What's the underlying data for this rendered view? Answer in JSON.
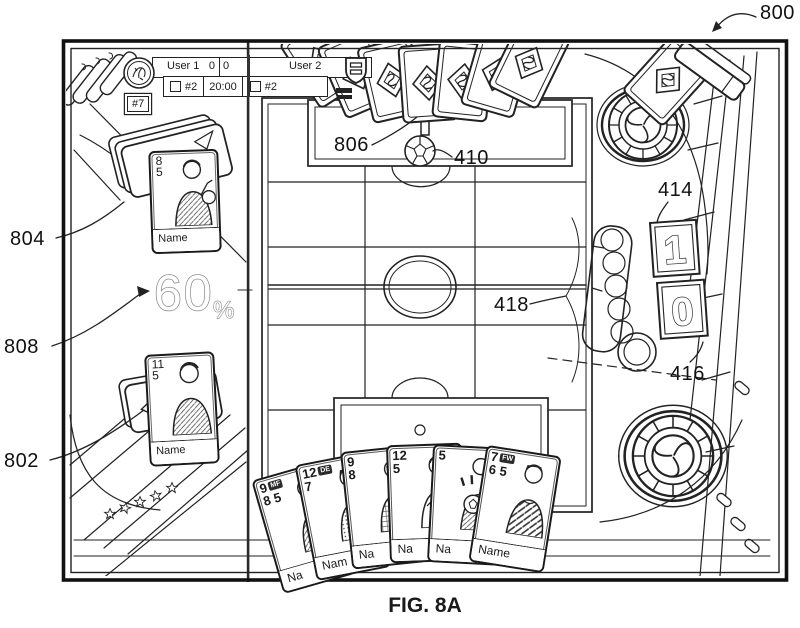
{
  "figure": {
    "label": "800",
    "caption": "FIG. 8A"
  },
  "refs": {
    "r804": "804",
    "r808": "808",
    "r802": "802",
    "r806": "806",
    "r410": "410",
    "r414": "414",
    "r416": "416",
    "r418": "418"
  },
  "scoreboard": {
    "user1": "User 1",
    "score_left": "0",
    "score_right": "0",
    "user2": "User 2",
    "left_jersey": "#2",
    "timer": "20:00",
    "right_jersey": "#2",
    "player_badge": "#7"
  },
  "possession": {
    "value": "60",
    "unit": "%"
  },
  "tiles": {
    "top": "1",
    "bottom": "0"
  },
  "card_gk": {
    "n1": "8",
    "n2": "5",
    "name": "Name"
  },
  "card_fp": {
    "n1": "11",
    "n2": "5",
    "name": "Name"
  },
  "hand": [
    {
      "n1": "9",
      "n2": "8",
      "n3": "5",
      "badge": "MF",
      "name": "Na"
    },
    {
      "n1": "12",
      "n2": "7",
      "n3": "",
      "badge": "DE",
      "name": "Nam"
    },
    {
      "n1": "9",
      "n2": "8",
      "n3": "",
      "badge": "",
      "name": "Na"
    },
    {
      "n1": "12",
      "n2": "5",
      "n3": "",
      "badge": "",
      "name": "Na"
    },
    {
      "n1": "5",
      "n2": "",
      "n3": "",
      "badge": "",
      "name": "Na"
    },
    {
      "n1": "7",
      "n2": "6",
      "n3": "5",
      "badge": "FW",
      "name": "Name"
    }
  ]
}
